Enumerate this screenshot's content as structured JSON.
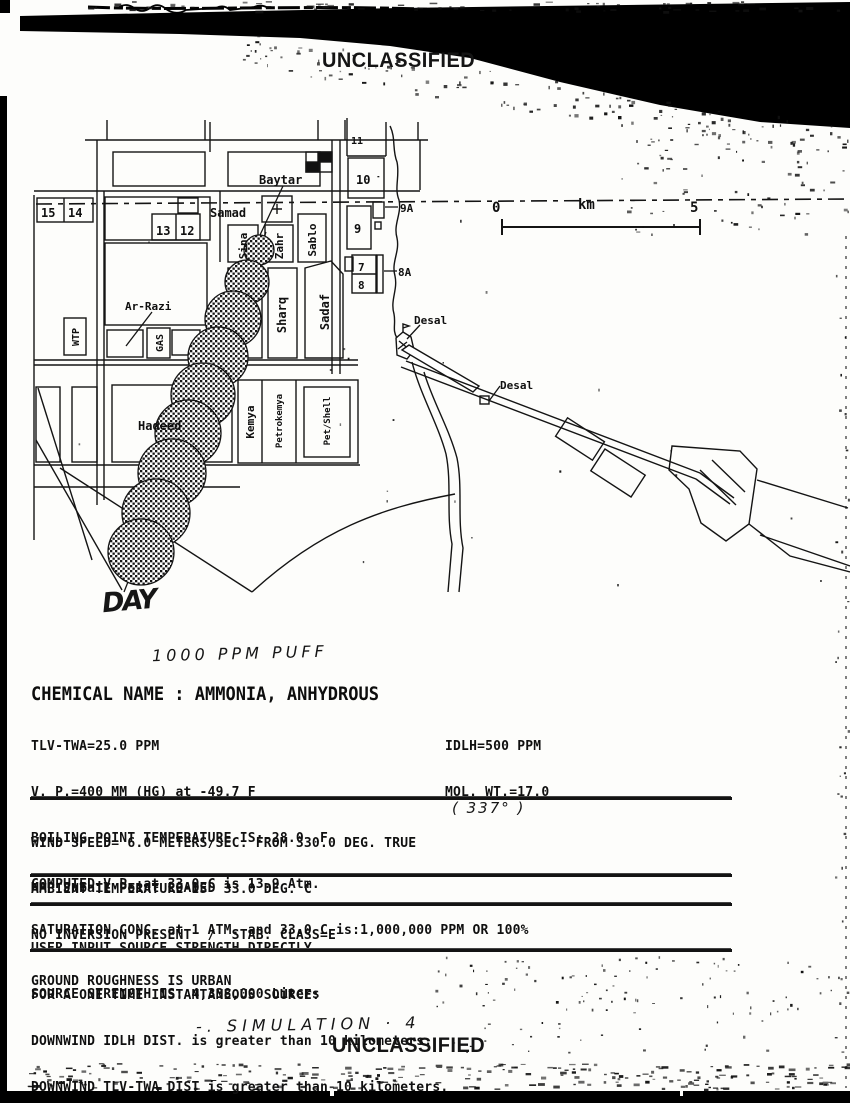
{
  "header": {
    "classification": "UNCLASSIFIED"
  },
  "footer": {
    "classification": "UNCLASSIFIED"
  },
  "handwriting": {
    "day_note": "DAY",
    "puff_note": "1000 PPM PUFF",
    "wind_correction": "( 337° )",
    "simulation_note": "-. SIMULATION · 4"
  },
  "map": {
    "name": "Jubail Point",
    "scale": {
      "start": "0",
      "unit": "km",
      "end": "5"
    },
    "labels": {
      "baytar": "Baytar",
      "samad": "Samad",
      "sina": "Sina",
      "zahr": "Zahr",
      "sablo": "Sablo",
      "sharq": "Sharq",
      "sadaf": "Sadaf",
      "ar_razi": "Ar-Razi",
      "wtp": "WTP",
      "gas": "GAS",
      "hadeed": "Hadeed",
      "kemya": "Kemya",
      "petrokemya": "Petrokemya",
      "pet_shell": "Pet/Shell",
      "desal_1": "Desal",
      "desal_2": "Desal",
      "b15": "15",
      "b14": "14",
      "b13": "13",
      "b12": "12",
      "b11": "11",
      "b10": "10",
      "b9": "9",
      "b9a": "9A",
      "b7": "7",
      "b8": "8",
      "b8a": "8A"
    }
  },
  "report": {
    "chemical_header": "CHEMICAL NAME : AMMONIA, ANHYDROUS",
    "properties": {
      "left": [
        "TLV-TWA=25.0 PPM",
        "V. P.=400 MM (HG) at -49.7 F",
        "BOILING POINT TEMPERATURE IS:-28.0  F",
        "COMPUTED V.P. at 33.0 C is 13.9 Atm.",
        "SATURATION CONC. at 1 ATM. and 33.0 C is:1,000,000 PPM OR 100%"
      ],
      "right": [
        "IDLH=500 PPM",
        "MOL. WT.=17.0"
      ]
    },
    "conditions": [
      "WIND SPEED= 6.0 METERS/SEC. FROM 330.0 DEG. TRUE",
      "AMBIENT TEMPERATURE IS  33.0 DEG. C",
      "NO INVERSION PRESENT  /  STAB. CLASS=E",
      "GROUND ROUGHNESS IS URBAN"
    ],
    "map_status": "MAP Jubail Point LOADED",
    "source": [
      "USER INPUT SOURCE STRENGTH DIRECTLY",
      "SOURCE STRENGTH IS: 4,338,000 Liters"
    ],
    "results": [
      "FOR A ONE TIME INSTANTANEOUS SOURCE:",
      "DOWNWIND IDLH DIST. is greater than 10 kilometers.",
      "DOWNWIND TLV-TWA DIST is greater than 10 kilometers.",
      "1,000 PPM DOWNWIND DIST. is greater than 10 kilometers."
    ]
  }
}
